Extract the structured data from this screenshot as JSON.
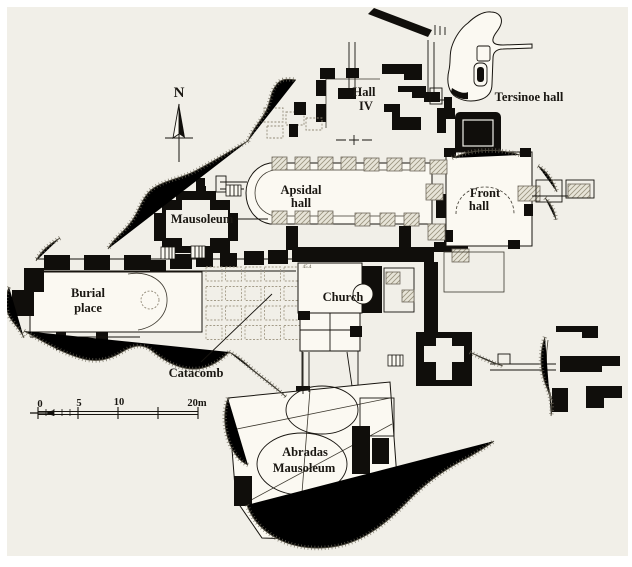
{
  "figure": {
    "type": "archaeological-site-plan",
    "colors": {
      "paper": "#f1efe8",
      "structure_fill": "#fbf9f2",
      "ink": "#100e0b",
      "hatch": "#6d675a"
    }
  },
  "compass": {
    "label": "N"
  },
  "scale_bar": {
    "ticks": [
      "0",
      "5",
      "10"
    ],
    "end": "20m"
  },
  "labels": {
    "hall_iv": {
      "line1": "Hall",
      "line2": "IV"
    },
    "tersinoe_hall": "Tersinoe hall",
    "apsidal_hall": {
      "line1": "Apsidal",
      "line2": "hall"
    },
    "front_hall": {
      "line1": "Front",
      "line2": "hall"
    },
    "mausoleum": "Mausoleum",
    "burial_place": {
      "line1": "Burial",
      "line2": "place"
    },
    "church": "Church",
    "catacomb": "Catacomb",
    "abradas_mausoleum": {
      "line1": "Abradas",
      "line2": "Mausoleum"
    },
    "elevation_mark": "45.4"
  }
}
